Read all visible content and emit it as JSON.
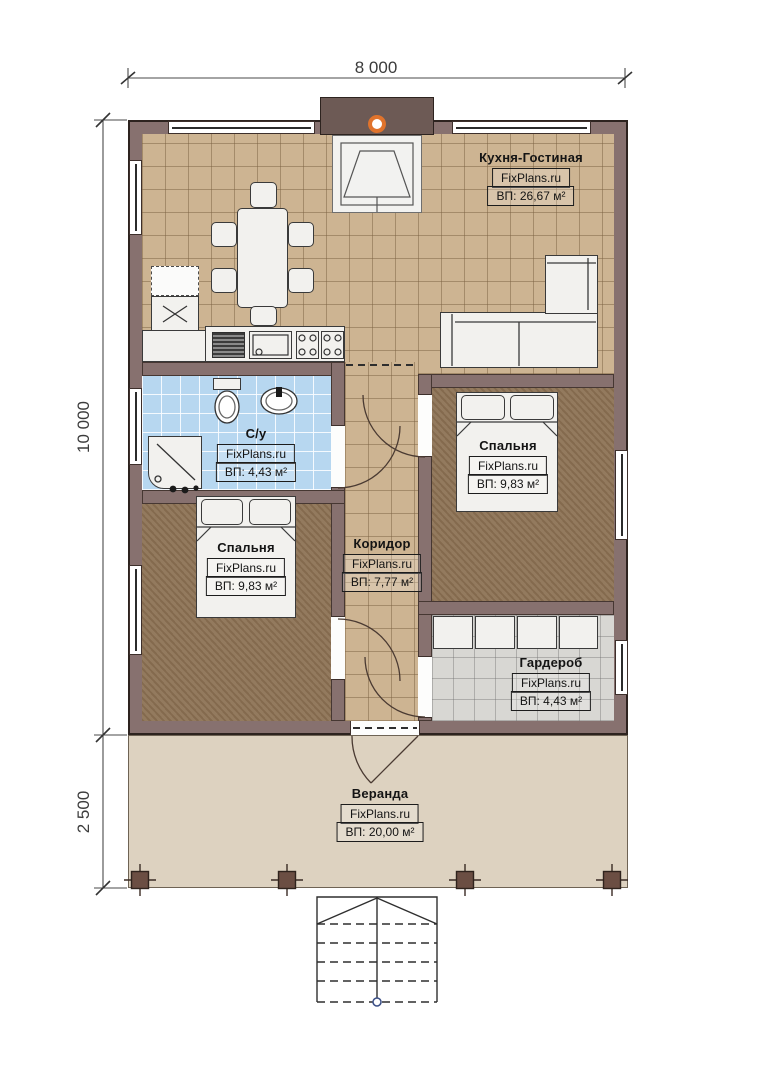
{
  "dimensions": {
    "top_width": "8 000",
    "left_height": "10 000",
    "veranda_height": "2 500"
  },
  "rooms": {
    "kitchen_living": {
      "name": "Кухня-Гостиная",
      "brand": "FixPlans.ru",
      "area": "ВП: 26,67 м²"
    },
    "bathroom": {
      "name": "С/у",
      "brand": "FixPlans.ru",
      "area": "ВП: 4,43 м²"
    },
    "bedroom_right": {
      "name": "Спальня",
      "brand": "FixPlans.ru",
      "area": "ВП: 9,83 м²"
    },
    "bedroom_left": {
      "name": "Спальня",
      "brand": "FixPlans.ru",
      "area": "ВП: 9,83 м²"
    },
    "corridor": {
      "name": "Коридор",
      "brand": "FixPlans.ru",
      "area": "ВП: 7,77 м²"
    },
    "wardrobe": {
      "name": "Гардероб",
      "brand": "FixPlans.ru",
      "area": "ВП: 4,43 м²"
    },
    "veranda": {
      "name": "Веранда",
      "brand": "FixPlans.ru",
      "area": "ВП: 20,00 м²"
    }
  },
  "colors": {
    "wall": "#87716f",
    "floor_tile": "#cdb492",
    "floor_bathroom": "#b7d7f0",
    "floor_bedroom": "#8d7355",
    "floor_wardrobe": "#d8d7d3",
    "floor_veranda": "#ddd2c0",
    "chimney_accent": "#e0732c"
  }
}
